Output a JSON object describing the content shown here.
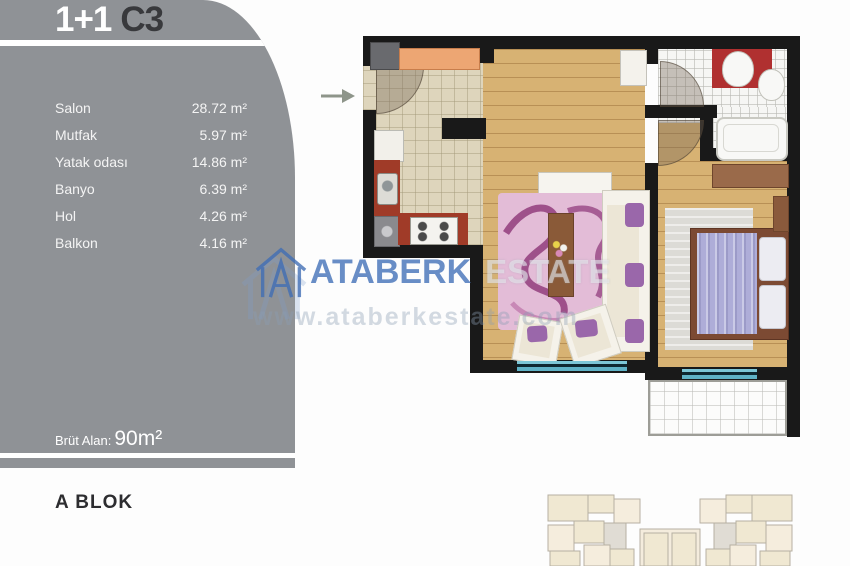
{
  "header": {
    "plan_type": "1+1",
    "unit_code": "C3"
  },
  "rooms": [
    {
      "label": "Salon",
      "value": "28.72 m²"
    },
    {
      "label": "Mutfak",
      "value": "5.97 m²"
    },
    {
      "label": "Yatak odası",
      "value": "14.86 m²"
    },
    {
      "label": "Banyo",
      "value": "6.39 m²"
    },
    {
      "label": "Hol",
      "value": "4.26 m²"
    },
    {
      "label": "Balkon",
      "value": "4.16 m²"
    }
  ],
  "footer": {
    "label": "Brüt Alan:",
    "value": "90m²"
  },
  "block_label": "A BLOK",
  "watermark": {
    "brand": "ATABERK",
    "suffix": "ESTATE",
    "url": "www.ataberkestate.com"
  },
  "colors": {
    "sidebar_gray": "#8f9296",
    "title_dark": "#38393c",
    "wall_black": "#191919",
    "wood_floor": "#d7b273",
    "kitchen_tile": "#ded5bc",
    "counter_red": "#a03b28",
    "counter_orange": "#eda673",
    "rug_pink": "#e3bcd7",
    "rug_swirl_purple": "#8c3577",
    "bed_lilac": "#aeadd8",
    "window_teal": "#5fb2c6",
    "watermark_blue": "#4270b8"
  }
}
